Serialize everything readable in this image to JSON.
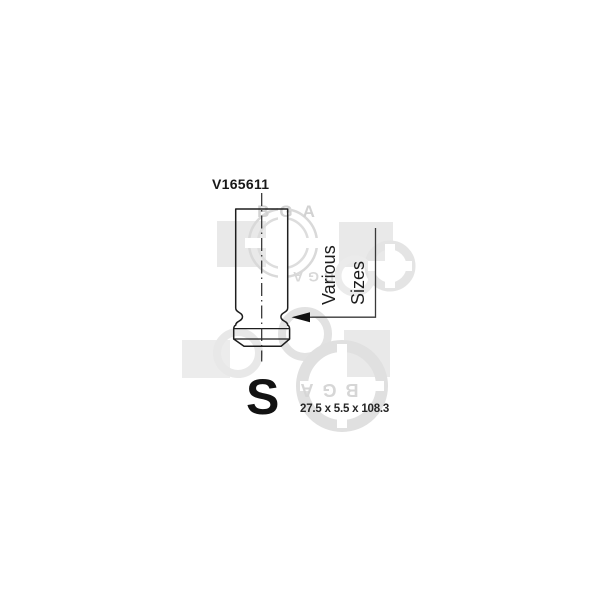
{
  "part": {
    "number": "V165611",
    "variant_letter": "S",
    "dimensions": "27.5 x 5.5 x 108.3"
  },
  "annotation": {
    "line1": "Various",
    "line2": "Sizes"
  },
  "watermark": {
    "brand": "BGA"
  },
  "colors": {
    "background": "#ffffff",
    "drawing_line": "#1e1e1e",
    "text": "#1a1a1a",
    "watermark_square": "#e9e9e9",
    "watermark_ring": "#dcdcdc",
    "watermark_letters": "#d4d4d4"
  }
}
